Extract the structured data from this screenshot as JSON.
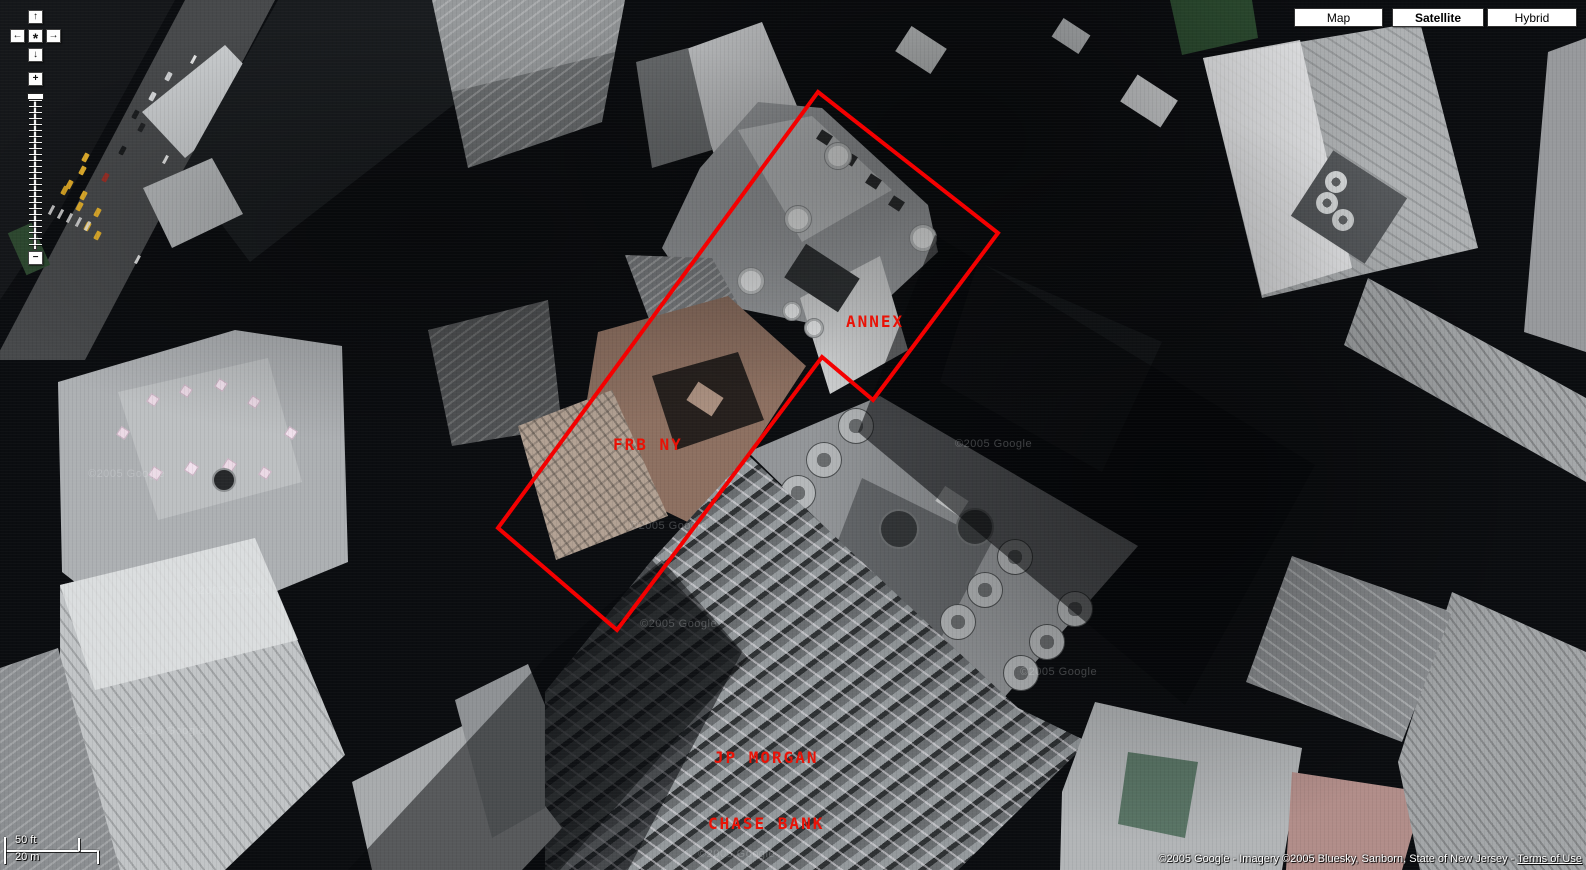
{
  "view_buttons": [
    {
      "label": "Map",
      "active": false
    },
    {
      "label": "Satellite",
      "active": true
    },
    {
      "label": "Hybrid",
      "active": false
    }
  ],
  "pan_control": {
    "up": "↑",
    "left": "←",
    "center": "*",
    "right": "→",
    "down": "↓"
  },
  "zoom_control": {
    "zoom_in": "+",
    "zoom_out": "−"
  },
  "scale_bar": {
    "imperial": "50 ft",
    "metric": "20 m"
  },
  "attribution": {
    "copyright": "©2005 Google - Imagery ©2005 Bluesky, Sanborn, State of New Jersey - ",
    "terms_link": "Terms of Use"
  },
  "annotations": {
    "outline_color": "#f40000",
    "label_color": "#ea1206",
    "building_outline_points": "818,92 998,233 873,400 822,357 617,630 498,528",
    "labels": {
      "annex": "ANNEX",
      "frb": "FRB NY",
      "jpm_line1": "JP MORGAN",
      "jpm_line2": "CHASE BANK"
    }
  },
  "watermark": {
    "text": "©2005 Google"
  }
}
